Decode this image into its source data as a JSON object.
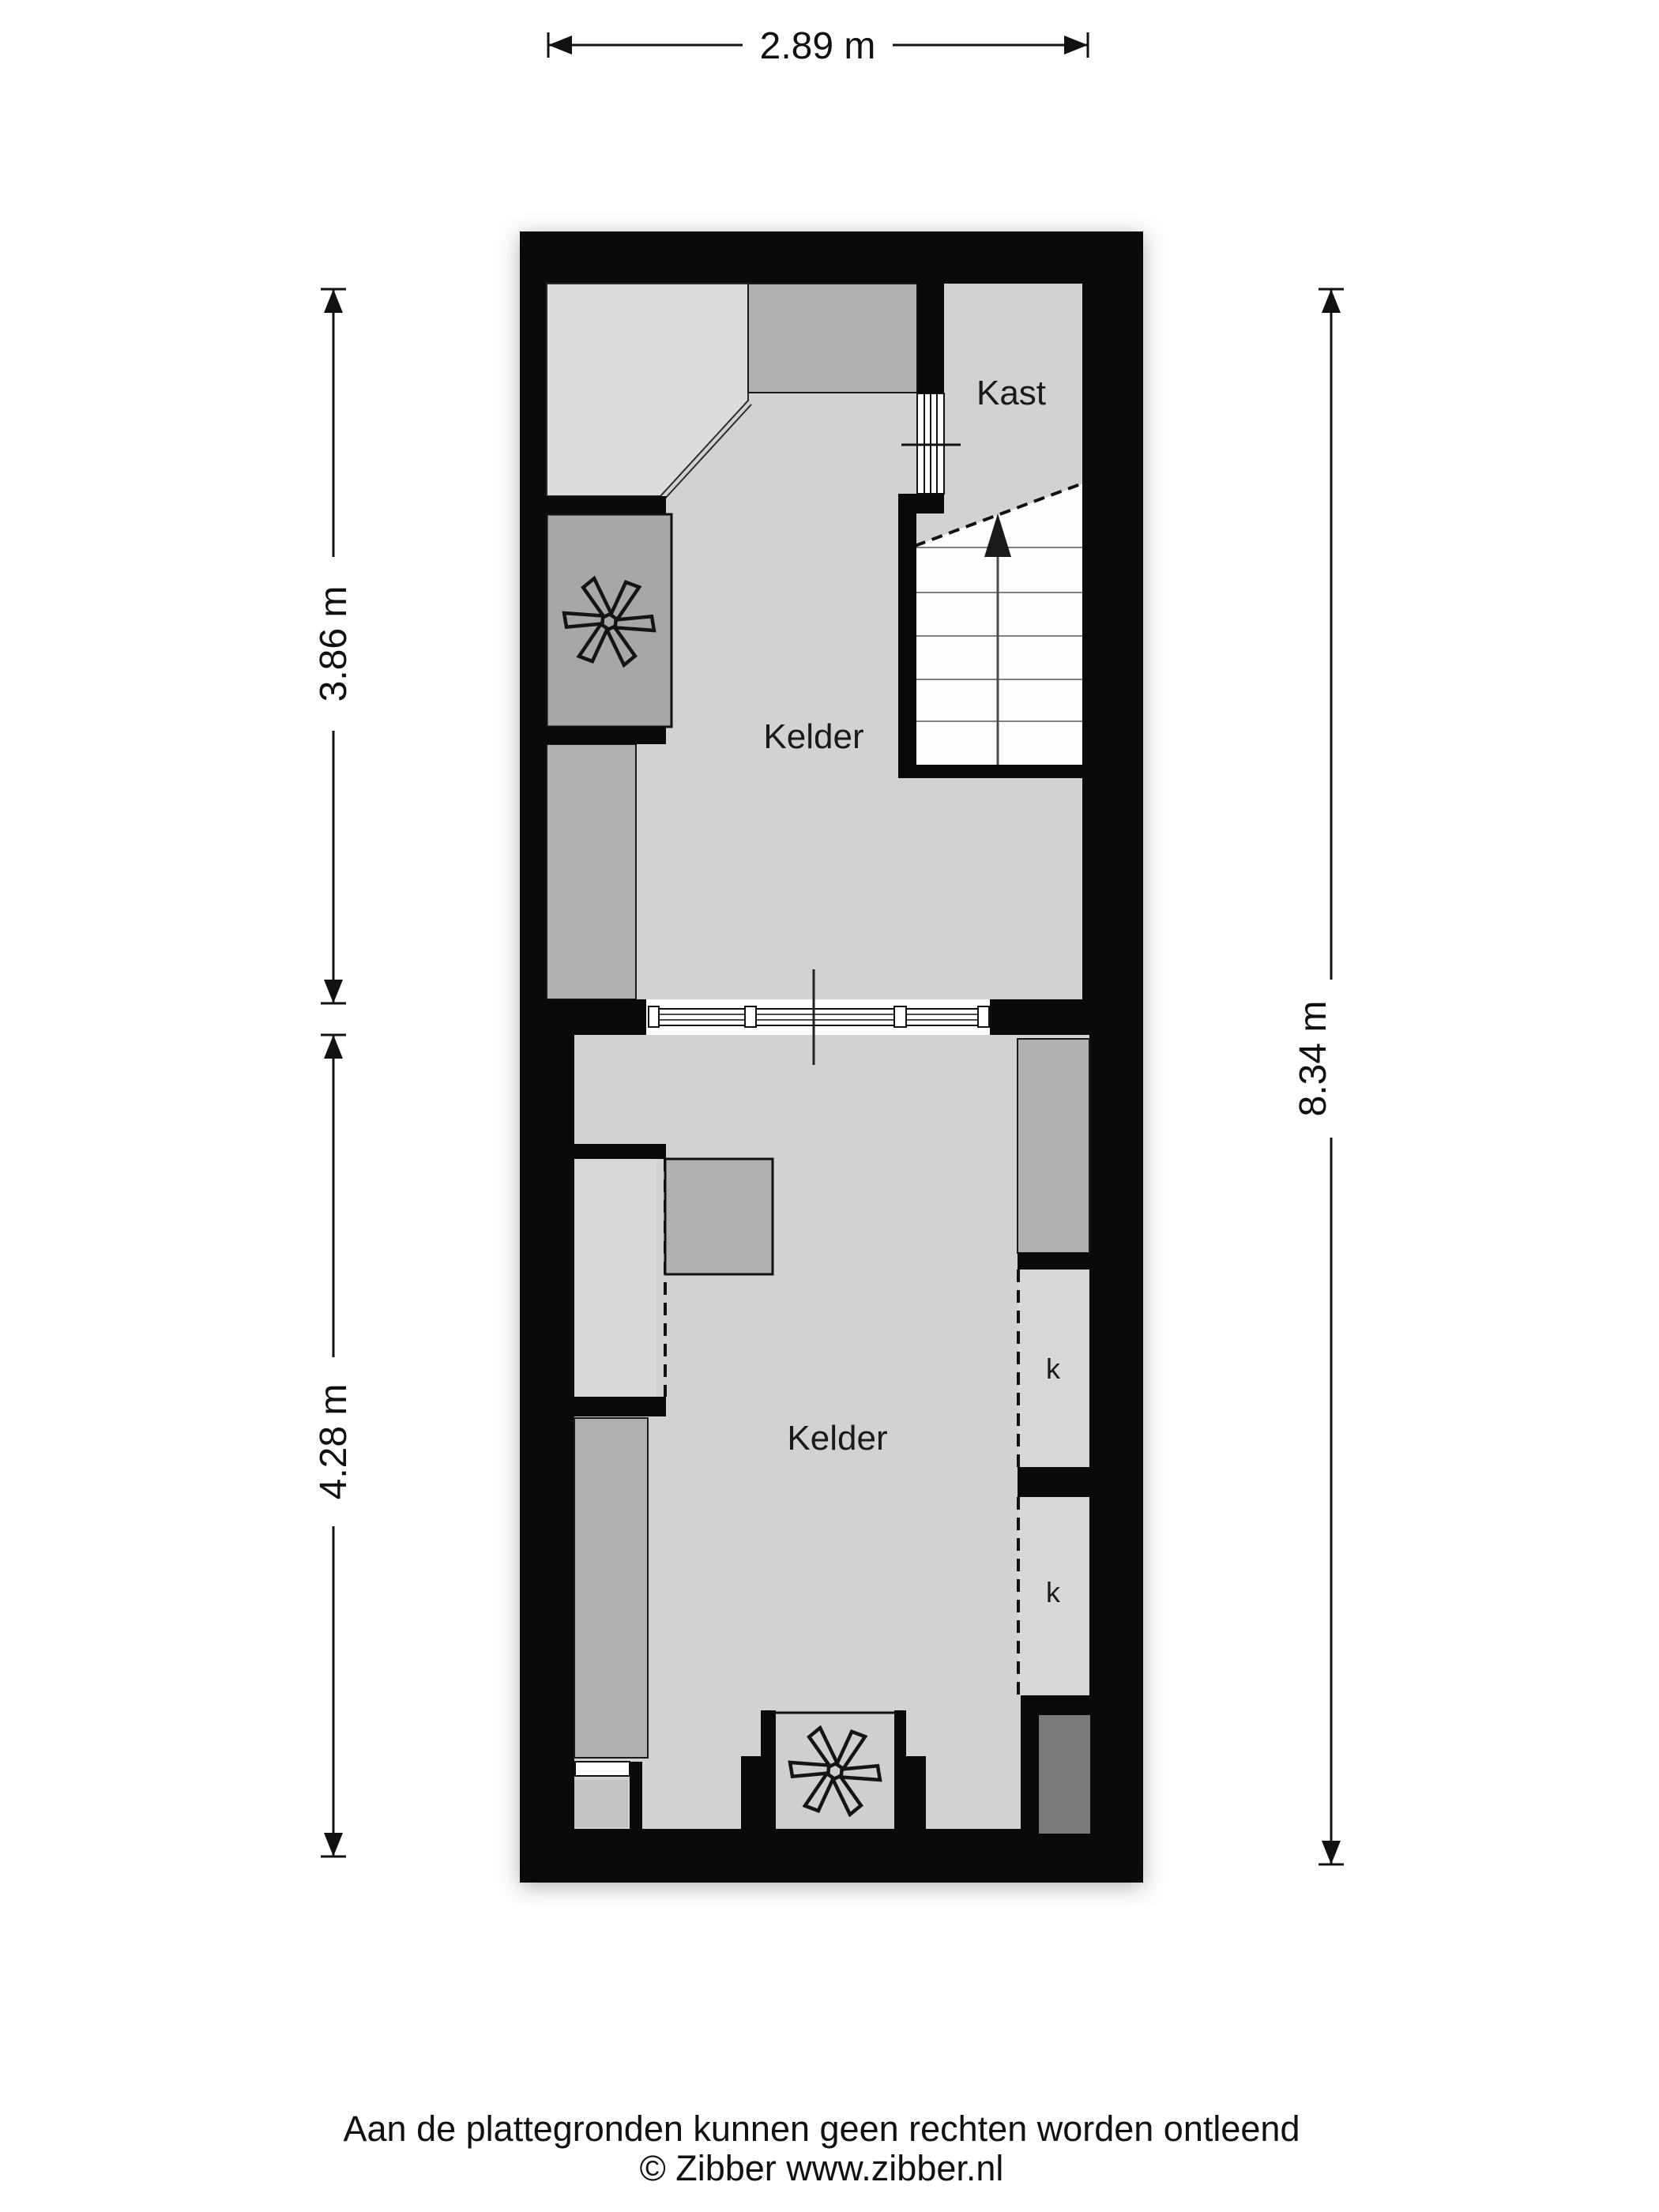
{
  "plan": {
    "rooms": {
      "kast_label": "Kast",
      "kelder_upper_label": "Kelder",
      "kelder_lower_label": "Kelder",
      "closet_top_label": "k",
      "closet_bottom_label": "k"
    },
    "dimensions": {
      "top_width": "2.89 m",
      "left_upper_height": "3.86 m",
      "left_lower_height": "4.28 m",
      "right_total_height": "8.34 m"
    },
    "icons": [
      {
        "name": "fan-icon",
        "location": "upper technical room"
      },
      {
        "name": "fan-icon",
        "location": "bottom wall niche"
      },
      {
        "name": "stairs-up-arrow-icon",
        "location": "staircase"
      },
      {
        "name": "door-opening-icon",
        "location": "kast entry"
      },
      {
        "name": "window-icon",
        "location": "middle window band"
      }
    ],
    "colors": {
      "wall": "#0a0a0a",
      "floor": "#d2d2d2",
      "room_light": "#dcdcdc",
      "furniture": "#b1b1b1",
      "technical_room": "#a7a7a7",
      "closet": "#d8d8d8",
      "dark_shaft": "#7a7a7a",
      "stairs": "#fdfdfd",
      "window_band": "#ffffff"
    }
  },
  "footer": {
    "disclaimer": "Aan de plattegronden kunnen geen rechten worden ontleend",
    "copyright": "© Zibber www.zibber.nl"
  }
}
